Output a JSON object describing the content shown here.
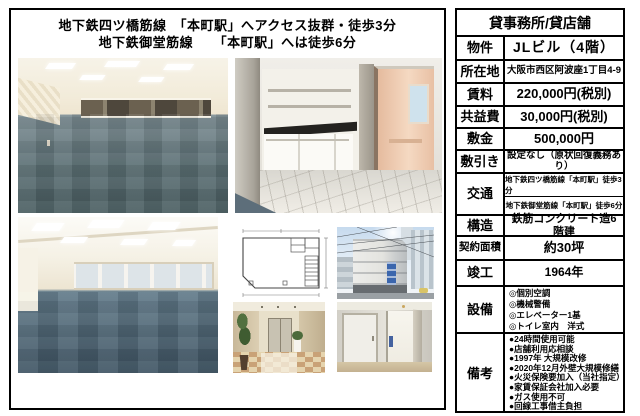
{
  "header": {
    "line1": "地下鉄四ツ橋筋線　「本町駅」へアクセス抜群・徒歩3分",
    "line2": "地下鉄御堂筋線　　「本町駅」へは徒歩6分"
  },
  "photos": {
    "office1": "office-room-blue-carpet",
    "kitchen": "kitchenette-with-door",
    "office2": "large-office-room-blue-carpet",
    "plan": "floor-plan-drawing",
    "building": "building-exterior-corner",
    "lobby": "entrance-lobby-with-plants",
    "hallway": "hallway-white-doors"
  },
  "table": {
    "title": "貸事務所/貸店舗",
    "rows": {
      "bukken": {
        "label": "物件",
        "value": "JLビル（4階）"
      },
      "shozaichi": {
        "label": "所在地",
        "value": "大阪市西区阿波座1丁目4-9"
      },
      "chinryo": {
        "label": "賃料",
        "value": "220,000円(税別)"
      },
      "kyoeki": {
        "label": "共益費",
        "value": "30,000円(税別)"
      },
      "shikikin": {
        "label": "敷金",
        "value": "500,000円"
      },
      "shikibiki": {
        "label": "敷引き",
        "value": "設定なし（原状回復義務あり）"
      },
      "kotsu": {
        "label": "交通",
        "value1": "地下鉄四ツ橋筋線「本町駅」徒歩3分",
        "value2": "地下鉄御堂筋線「本町駅」徒歩6分"
      },
      "kozo": {
        "label": "構造",
        "value": "鉄筋コンクリート造6階建"
      },
      "menseki": {
        "label": "契約面積",
        "value": "約30坪"
      },
      "shunko": {
        "label": "竣工",
        "value": "1964年"
      },
      "setsubi": {
        "label": "設備",
        "items": [
          "◎個別空調",
          "◎機械警備",
          "◎エレベーター1基",
          "◎トイレ室内　洋式"
        ]
      },
      "biko": {
        "label": "備考",
        "items": [
          "●24時間使用可能",
          "●店舗利用応相談",
          "●1997年 大規模改修",
          "●2020年12月外壁大規模修繕",
          "●火災保険要加入（当社指定）",
          "●家賃保証会社加入必要",
          "●ガス使用不可",
          "●回線工事借主負担"
        ]
      }
    }
  },
  "colors": {
    "carpet": "#5b6f74",
    "carpet2": "#4f6a7a",
    "wall_cream": "#f1e9d7",
    "sign_blue": "#3b66ad",
    "sky": "#c6daee",
    "border": "#000000"
  }
}
